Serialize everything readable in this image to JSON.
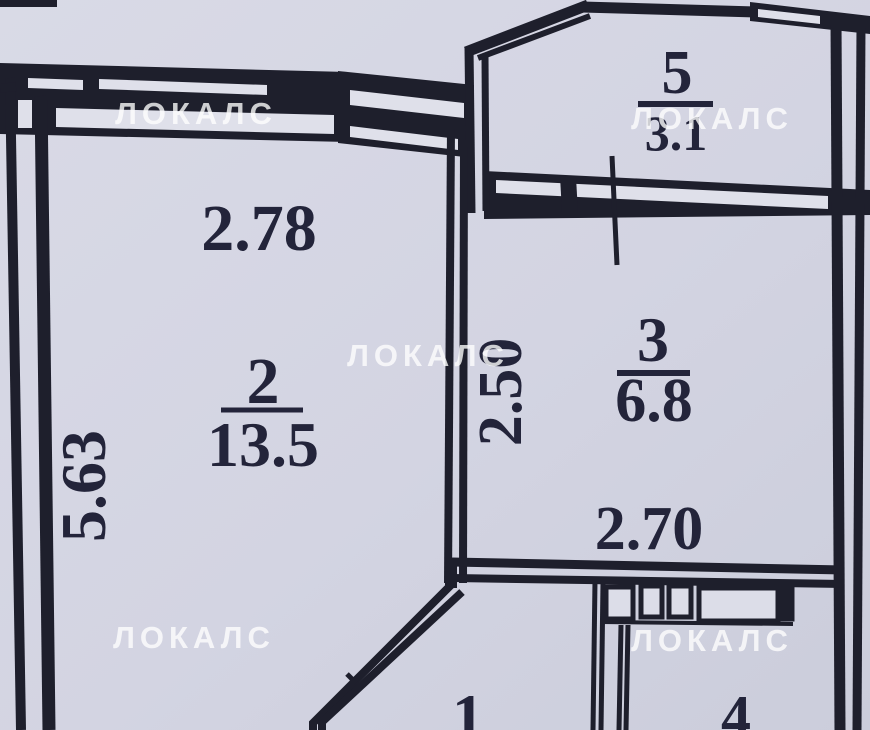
{
  "plan": {
    "title": "apartment-floor-plan-scan",
    "watermark": "ЛОКАЛС",
    "rooms": {
      "room1": {
        "number": "1"
      },
      "room2": {
        "number": "2",
        "area": "13.5",
        "width_m": "2.78",
        "depth_m": "5.63"
      },
      "room3": {
        "number": "3",
        "area": "6.8",
        "width_m": "2.70",
        "depth_m": "2.50"
      },
      "room4": {
        "number": "4"
      },
      "room5": {
        "number": "5",
        "area": "3.1"
      }
    },
    "colors": {
      "background": "#d3d4e1",
      "background_light": "#dcdde8",
      "wall": "#1e1f2c",
      "label_text": "#23243a",
      "watermark": "#ffffff"
    }
  }
}
